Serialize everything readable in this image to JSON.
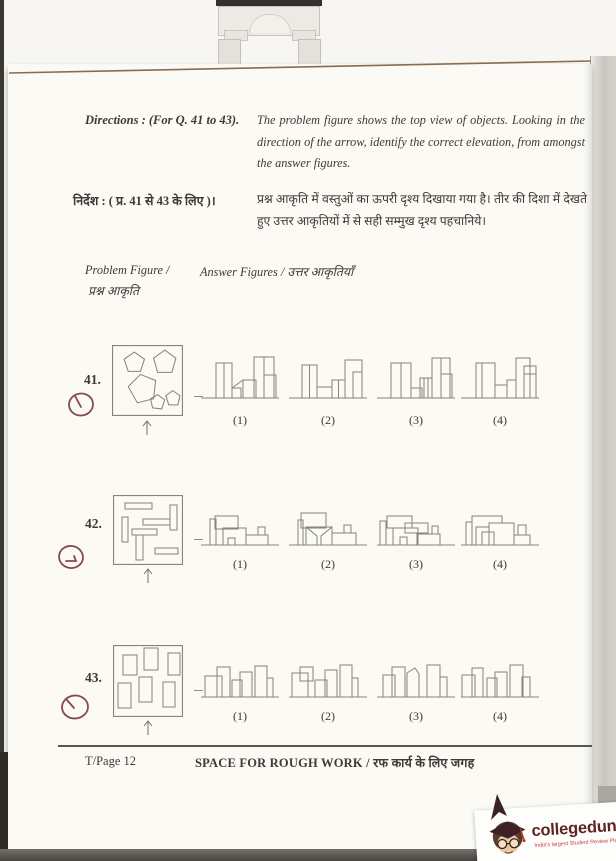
{
  "colors": {
    "page_bg": "#fbfaf5",
    "ink": "#3e3a35",
    "figure_line": "#85837d",
    "pen_mark": "#7d3343",
    "page_edge": "#8d6b4c",
    "brand_text": "#5f2320",
    "brand_tagline": "#c34040"
  },
  "doc": {
    "directions_label_en": "Directions : (For Q. 41 to 43).",
    "directions_text_en": "The problem figure shows the top view of objects.  Looking in the direction of the arrow, identify the correct elevation, from amongst the answer figures.",
    "directions_label_hi": "निर्देश : ( प्र. 41  से 43 के लिए )।",
    "directions_text_hi": "प्रश्न आकृति में वस्तुओं का ऊपरी दृश्य दिखाया गया है।  तीर की दिशा में देखते हुए उत्तर आकृतियों में से सही सम्मुख दृश्य पहचानिये।",
    "problem_figure_label_en": "Problem Figure /",
    "problem_figure_label_hi": "प्रश्न आकृति",
    "answer_figures_label": "Answer Figures / उत्तर आकृतियाँ",
    "footer_page": "T/Page 12",
    "footer_center": "SPACE FOR ROUGH WORK / रफ कार्य के लिए जगह"
  },
  "questions": [
    {
      "number": "41.",
      "options": [
        "(1)",
        "(2)",
        "(3)",
        "(4)"
      ]
    },
    {
      "number": "42.",
      "options": [
        "(1)",
        "(2)",
        "(3)",
        "(4)"
      ]
    },
    {
      "number": "43.",
      "options": [
        "(1)",
        "(2)",
        "(3)",
        "(4)"
      ]
    }
  ],
  "watermark": {
    "brand": "collegedunia",
    "tagline": "India's largest Student Review Platform"
  },
  "figures": {
    "q41": {
      "problem": {
        "vw": 70,
        "vh": 70,
        "shapes": [
          {
            "t": "r",
            "x": 0.5,
            "y": 0.5,
            "w": 69,
            "h": 69,
            "sw": 1.2
          },
          {
            "t": "p",
            "pts": "22,7 32,14 28,26 16,26 12,14"
          },
          {
            "t": "p",
            "pts": "52,5 63,13 59,27 45,27 41,13"
          },
          {
            "t": "p",
            "pts": "28,29 43,35 41,53 25,57 16,41"
          },
          {
            "t": "p",
            "pts": "45,49 52,54 49,63 40,62 38,53"
          },
          {
            "t": "p",
            "pts": "60,45 67,50 65,59 56,59 53,50"
          }
        ]
      },
      "options": [
        {
          "vw": 80,
          "vh": 50,
          "shapes": [
            {
              "t": "l",
              "x1": 1,
              "y1": 46,
              "x2": 79,
              "y2": 46
            },
            {
              "t": "r",
              "x": 16,
              "y": 11,
              "w": 16,
              "h": 35
            },
            {
              "t": "l",
              "x1": 24,
              "y1": 11,
              "x2": 24,
              "y2": 46
            },
            {
              "t": "r",
              "x": 32,
              "y": 36,
              "w": 9,
              "h": 10
            },
            {
              "t": "l",
              "x1": 32,
              "y1": 36,
              "x2": 43,
              "y2": 28
            },
            {
              "t": "r",
              "x": 43,
              "y": 28,
              "w": 13,
              "h": 18
            },
            {
              "t": "r",
              "x": 54,
              "y": 5,
              "w": 20,
              "h": 41
            },
            {
              "t": "l",
              "x1": 64,
              "y1": 5,
              "x2": 64,
              "y2": 46
            },
            {
              "t": "r",
              "x": 64,
              "y": 23,
              "w": 12,
              "h": 23
            }
          ]
        },
        {
          "vw": 80,
          "vh": 50,
          "shapes": [
            {
              "t": "l",
              "x1": 1,
              "y1": 46,
              "x2": 79,
              "y2": 46
            },
            {
              "t": "r",
              "x": 14,
              "y": 13,
              "w": 15,
              "h": 33
            },
            {
              "t": "l",
              "x1": 21.5,
              "y1": 13,
              "x2": 21.5,
              "y2": 46
            },
            {
              "t": "r",
              "x": 29,
              "y": 35,
              "w": 15,
              "h": 11
            },
            {
              "t": "r",
              "x": 44,
              "y": 28,
              "w": 13,
              "h": 18
            },
            {
              "t": "l",
              "x1": 50.5,
              "y1": 28,
              "x2": 50.5,
              "y2": 46
            },
            {
              "t": "r",
              "x": 57,
              "y": 8,
              "w": 17,
              "h": 38
            },
            {
              "t": "r",
              "x": 65,
              "y": 20,
              "w": 9,
              "h": 26
            }
          ]
        },
        {
          "vw": 80,
          "vh": 50,
          "shapes": [
            {
              "t": "l",
              "x1": 1,
              "y1": 46,
              "x2": 79,
              "y2": 46
            },
            {
              "t": "r",
              "x": 15,
              "y": 11,
              "w": 20,
              "h": 35
            },
            {
              "t": "l",
              "x1": 25,
              "y1": 11,
              "x2": 25,
              "y2": 46
            },
            {
              "t": "r",
              "x": 35,
              "y": 36,
              "w": 11,
              "h": 10
            },
            {
              "t": "r",
              "x": 44,
              "y": 26,
              "w": 12,
              "h": 20
            },
            {
              "t": "l",
              "x1": 48,
              "y1": 26,
              "x2": 48,
              "y2": 46
            },
            {
              "t": "l",
              "x1": 52,
              "y1": 26,
              "x2": 52,
              "y2": 46
            },
            {
              "t": "r",
              "x": 56,
              "y": 6,
              "w": 18,
              "h": 40
            },
            {
              "t": "l",
              "x1": 65,
              "y1": 6,
              "x2": 65,
              "y2": 46
            },
            {
              "t": "r",
              "x": 65,
              "y": 22,
              "w": 11,
              "h": 24
            }
          ]
        },
        {
          "vw": 80,
          "vh": 50,
          "shapes": [
            {
              "t": "l",
              "x1": 1,
              "y1": 46,
              "x2": 79,
              "y2": 46
            },
            {
              "t": "r",
              "x": 16,
              "y": 11,
              "w": 19,
              "h": 35
            },
            {
              "t": "l",
              "x1": 22,
              "y1": 11,
              "x2": 22,
              "y2": 46
            },
            {
              "t": "r",
              "x": 35,
              "y": 33,
              "w": 12,
              "h": 13
            },
            {
              "t": "r",
              "x": 47,
              "y": 28,
              "w": 9,
              "h": 18
            },
            {
              "t": "r",
              "x": 56,
              "y": 6,
              "w": 14,
              "h": 40
            },
            {
              "t": "r",
              "x": 64,
              "y": 14,
              "w": 12,
              "h": 32
            },
            {
              "t": "l",
              "x1": 64,
              "y1": 22,
              "x2": 76,
              "y2": 22
            }
          ]
        }
      ]
    },
    "q42": {
      "problem": {
        "vw": 70,
        "vh": 70,
        "shapes": [
          {
            "t": "r",
            "x": 0.5,
            "y": 0.5,
            "w": 69,
            "h": 69,
            "sw": 1.2
          },
          {
            "t": "r",
            "x": 12,
            "y": 8,
            "w": 27,
            "h": 6
          },
          {
            "t": "r",
            "x": 9,
            "y": 22,
            "w": 6,
            "h": 25
          },
          {
            "t": "r",
            "x": 30,
            "y": 24,
            "w": 27,
            "h": 6
          },
          {
            "t": "r",
            "x": 57,
            "y": 10,
            "w": 7,
            "h": 25
          },
          {
            "t": "r",
            "x": 19,
            "y": 34,
            "w": 25,
            "h": 6
          },
          {
            "t": "r",
            "x": 23,
            "y": 40,
            "w": 7,
            "h": 25
          },
          {
            "t": "r",
            "x": 42,
            "y": 53,
            "w": 23,
            "h": 6
          }
        ]
      },
      "options": [
        {
          "vw": 80,
          "vh": 50,
          "shapes": [
            {
              "t": "l",
              "x1": 1,
              "y1": 46,
              "x2": 79,
              "y2": 46
            },
            {
              "t": "r",
              "x": 10,
              "y": 20,
              "w": 6,
              "h": 26
            },
            {
              "t": "r",
              "x": 15,
              "y": 17,
              "w": 23,
              "h": 13
            },
            {
              "t": "r",
              "x": 23,
              "y": 29,
              "w": 23,
              "h": 17
            },
            {
              "t": "r",
              "x": 28,
              "y": 39,
              "w": 7,
              "h": 7
            },
            {
              "t": "r",
              "x": 46,
              "y": 36,
              "w": 22,
              "h": 10
            },
            {
              "t": "r",
              "x": 58,
              "y": 28,
              "w": 7,
              "h": 8
            }
          ]
        },
        {
          "vw": 80,
          "vh": 50,
          "shapes": [
            {
              "t": "l",
              "x1": 1,
              "y1": 46,
              "x2": 79,
              "y2": 46
            },
            {
              "t": "r",
              "x": 10,
              "y": 21,
              "w": 5,
              "h": 25
            },
            {
              "t": "r",
              "x": 13,
              "y": 14,
              "w": 25,
              "h": 15
            },
            {
              "t": "r",
              "x": 18,
              "y": 28,
              "w": 26,
              "h": 18
            },
            {
              "t": "pl",
              "pts": "18,28 29,37 29,46"
            },
            {
              "t": "pl",
              "pts": "44,28 33,37 33,46"
            },
            {
              "t": "r",
              "x": 44,
              "y": 34,
              "w": 24,
              "h": 12
            },
            {
              "t": "r",
              "x": 56,
              "y": 26,
              "w": 7,
              "h": 8
            }
          ]
        },
        {
          "vw": 80,
          "vh": 50,
          "shapes": [
            {
              "t": "l",
              "x1": 1,
              "y1": 46,
              "x2": 79,
              "y2": 46
            },
            {
              "t": "r",
              "x": 4,
              "y": 22,
              "w": 6,
              "h": 24
            },
            {
              "t": "r",
              "x": 11,
              "y": 17,
              "w": 25,
              "h": 12
            },
            {
              "t": "r",
              "x": 17,
              "y": 29,
              "w": 25,
              "h": 17
            },
            {
              "t": "r",
              "x": 24,
              "y": 38,
              "w": 7,
              "h": 8
            },
            {
              "t": "r",
              "x": 29,
              "y": 24,
              "w": 23,
              "h": 10
            },
            {
              "t": "r",
              "x": 41,
              "y": 35,
              "w": 23,
              "h": 11
            },
            {
              "t": "r",
              "x": 56,
              "y": 27,
              "w": 6,
              "h": 8
            }
          ]
        },
        {
          "vw": 80,
          "vh": 50,
          "shapes": [
            {
              "t": "l",
              "x1": 1,
              "y1": 46,
              "x2": 79,
              "y2": 46
            },
            {
              "t": "r",
              "x": 6,
              "y": 23,
              "w": 6,
              "h": 23
            },
            {
              "t": "pl",
              "pts": "12,23 12,17 42,17 42,24"
            },
            {
              "t": "r",
              "x": 16,
              "y": 28,
              "w": 13,
              "h": 18
            },
            {
              "t": "r",
              "x": 22,
              "y": 33,
              "w": 12,
              "h": 13
            },
            {
              "t": "r",
              "x": 29,
              "y": 24,
              "w": 25,
              "h": 22
            },
            {
              "t": "r",
              "x": 54,
              "y": 36,
              "w": 16,
              "h": 10
            },
            {
              "t": "r",
              "x": 58,
              "y": 26,
              "w": 8,
              "h": 10
            }
          ]
        }
      ]
    },
    "q43": {
      "problem": {
        "vw": 70,
        "vh": 72,
        "shapes": [
          {
            "t": "r",
            "x": 0.5,
            "y": 0.5,
            "w": 69,
            "h": 71,
            "sw": 1.2
          },
          {
            "t": "r",
            "x": 10,
            "y": 10,
            "w": 14,
            "h": 20
          },
          {
            "t": "r",
            "x": 31,
            "y": 3,
            "w": 14,
            "h": 22
          },
          {
            "t": "r",
            "x": 55,
            "y": 8,
            "w": 12,
            "h": 22
          },
          {
            "t": "r",
            "x": 5,
            "y": 38,
            "w": 13,
            "h": 25
          },
          {
            "t": "r",
            "x": 26,
            "y": 32,
            "w": 13,
            "h": 25
          },
          {
            "t": "r",
            "x": 50,
            "y": 37,
            "w": 12,
            "h": 25
          }
        ]
      },
      "options": [
        {
          "vw": 80,
          "vh": 50,
          "shapes": [
            {
              "t": "l",
              "x1": 1,
              "y1": 46,
              "x2": 79,
              "y2": 46
            },
            {
              "t": "r",
              "x": 5,
              "y": 25,
              "w": 17,
              "h": 21
            },
            {
              "t": "r",
              "x": 17,
              "y": 16,
              "w": 13,
              "h": 30
            },
            {
              "t": "r",
              "x": 32,
              "y": 29,
              "w": 10,
              "h": 17
            },
            {
              "t": "r",
              "x": 40,
              "y": 21,
              "w": 12,
              "h": 25
            },
            {
              "t": "r",
              "x": 55,
              "y": 15,
              "w": 12,
              "h": 31
            },
            {
              "t": "r",
              "x": 67,
              "y": 27,
              "w": 6,
              "h": 19
            }
          ]
        },
        {
          "vw": 80,
          "vh": 50,
          "shapes": [
            {
              "t": "l",
              "x1": 1,
              "y1": 46,
              "x2": 79,
              "y2": 46
            },
            {
              "t": "r",
              "x": 4,
              "y": 22,
              "w": 16,
              "h": 24
            },
            {
              "t": "r",
              "x": 12,
              "y": 16,
              "w": 13,
              "h": 14
            },
            {
              "t": "r",
              "x": 27,
              "y": 29,
              "w": 12,
              "h": 17
            },
            {
              "t": "r",
              "x": 37,
              "y": 19,
              "w": 12,
              "h": 27
            },
            {
              "t": "r",
              "x": 52,
              "y": 14,
              "w": 12,
              "h": 32
            },
            {
              "t": "r",
              "x": 64,
              "y": 27,
              "w": 6,
              "h": 19
            }
          ]
        },
        {
          "vw": 80,
          "vh": 50,
          "shapes": [
            {
              "t": "l",
              "x1": 1,
              "y1": 46,
              "x2": 79,
              "y2": 46
            },
            {
              "t": "r",
              "x": 7,
              "y": 24,
              "w": 12,
              "h": 22
            },
            {
              "t": "r",
              "x": 16,
              "y": 16,
              "w": 13,
              "h": 30
            },
            {
              "t": "p",
              "pts": "31,46 31,22 39,17 43,23 43,46"
            },
            {
              "t": "r",
              "x": 51,
              "y": 14,
              "w": 13,
              "h": 32
            },
            {
              "t": "r",
              "x": 64,
              "y": 26,
              "w": 7,
              "h": 20
            }
          ]
        },
        {
          "vw": 80,
          "vh": 50,
          "shapes": [
            {
              "t": "l",
              "x1": 1,
              "y1": 46,
              "x2": 79,
              "y2": 46
            },
            {
              "t": "r",
              "x": 2,
              "y": 24,
              "w": 13,
              "h": 22
            },
            {
              "t": "r",
              "x": 12,
              "y": 17,
              "w": 11,
              "h": 29
            },
            {
              "t": "r",
              "x": 27,
              "y": 27,
              "w": 10,
              "h": 19
            },
            {
              "t": "r",
              "x": 35,
              "y": 21,
              "w": 12,
              "h": 25
            },
            {
              "t": "r",
              "x": 50,
              "y": 14,
              "w": 13,
              "h": 32
            },
            {
              "t": "r",
              "x": 62,
              "y": 26,
              "w": 8,
              "h": 20
            }
          ]
        }
      ]
    }
  }
}
